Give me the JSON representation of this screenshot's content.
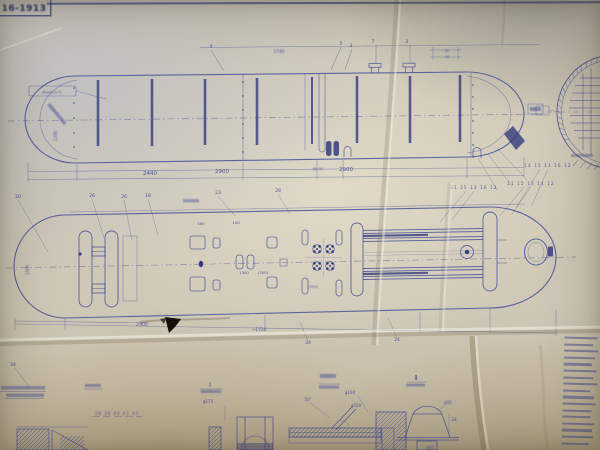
{
  "title_block": {
    "drawing_number": "16-1913"
  },
  "colors": {
    "ink": "#3f4896",
    "ink_dark": "#343b7e",
    "paper": "#cfc8b7",
    "tear": "#141008"
  },
  "notes_column": {
    "line_widths": [
      33,
      29,
      34,
      31,
      28,
      33,
      30,
      34,
      27,
      31,
      33,
      29,
      28,
      32,
      30,
      31,
      27
    ]
  },
  "annotations": [
    {
      "t": "2440",
      "x": 150,
      "y": 175,
      "s": 5.5,
      "n": "dim-2440"
    },
    {
      "t": "2900",
      "x": 222,
      "y": 173,
      "s": 5.5,
      "n": "dim-2900-a"
    },
    {
      "t": "80 40",
      "x": 318,
      "y": 170,
      "s": 3.6,
      "b": 0.4,
      "n": "dim-80-40"
    },
    {
      "t": "2900",
      "x": 346,
      "y": 171,
      "s": 5.5,
      "n": "dim-2900-b"
    },
    {
      "t": "5740",
      "x": 279,
      "y": 53,
      "s": 4.2,
      "b": 0.5,
      "n": "dim-5740"
    },
    {
      "t": "4",
      "x": 211,
      "y": 48,
      "s": 4.6,
      "n": "balloon-4"
    },
    {
      "t": "5",
      "x": 341,
      "y": 45,
      "s": 4.6,
      "n": "balloon-5"
    },
    {
      "t": "3",
      "x": 351,
      "y": 47,
      "s": 4.6,
      "n": "balloon-3"
    },
    {
      "t": "7",
      "x": 373,
      "y": 43,
      "s": 4.6,
      "n": "balloon-7"
    },
    {
      "t": "2",
      "x": 407,
      "y": 43,
      "s": 4.6,
      "n": "balloon-2"
    },
    {
      "t": "50",
      "x": 447,
      "y": 52,
      "s": 3.4,
      "b": 0.4,
      "n": "dim-50"
    },
    {
      "t": "40",
      "x": 447,
      "y": 58,
      "s": 3.4,
      "b": 0.4,
      "n": "dim-40"
    },
    {
      "t": "8mm≈175",
      "x": 52,
      "y": 93.5,
      "s": 3.6,
      "b": 0.5,
      "n": "note-8mm"
    },
    {
      "t": "1200",
      "x": 57,
      "y": 136,
      "s": 4,
      "r": -90,
      "b": 0.5,
      "n": "dim-1200"
    },
    {
      "t": "20",
      "x": 18,
      "y": 198,
      "s": 4.6,
      "n": "balloon-20"
    },
    {
      "t": "26",
      "x": 92,
      "y": 197,
      "s": 4.6,
      "n": "balloon-26-a"
    },
    {
      "t": "26",
      "x": 124,
      "y": 198,
      "s": 4.6,
      "n": "balloon-26-b"
    },
    {
      "t": "18",
      "x": 148,
      "y": 197,
      "s": 4.6,
      "n": "balloon-18"
    },
    {
      "t": "23",
      "x": 218,
      "y": 194,
      "s": 4.6,
      "n": "balloon-23"
    },
    {
      "t": "28",
      "x": 278,
      "y": 192,
      "s": 4.6,
      "n": "balloon-28"
    },
    {
      "t": "14 15 13 16 12",
      "x": 548,
      "y": 167,
      "s": 4,
      "ls": 1.2,
      "n": "balloon-row-a"
    },
    {
      "t": "11 15 13 14 12",
      "x": 531,
      "y": 185,
      "s": 4,
      "ls": 1.2,
      "n": "balloon-row-b"
    },
    {
      "t": "21 25 13 16 12",
      "x": 474,
      "y": 189,
      "s": 4,
      "ls": 1.2,
      "n": "balloon-row-c"
    },
    {
      "t": "580",
      "x": 201,
      "y": 225,
      "s": 3.8,
      "n": "dim-580"
    },
    {
      "t": "100",
      "x": 236,
      "y": 224,
      "s": 3.8,
      "n": "dim-100"
    },
    {
      "t": "1300",
      "x": 244,
      "y": 274,
      "s": 3.8,
      "n": "dim-1300"
    },
    {
      "t": "(300)",
      "x": 263,
      "y": 274,
      "s": 3.8,
      "n": "dim-300"
    },
    {
      "t": "(350)",
      "x": 313,
      "y": 288,
      "s": 3.8,
      "b": 0.4,
      "n": "dim-350"
    },
    {
      "t": "2905",
      "x": 142,
      "y": 326,
      "s": 4.6,
      "n": "dim-2905"
    },
    {
      "t": "~1724",
      "x": 259,
      "y": 331,
      "s": 4.2,
      "n": "dim-1724"
    },
    {
      "t": "34",
      "x": 308,
      "y": 344,
      "s": 4.6,
      "n": "balloon-34-a"
    },
    {
      "t": "24",
      "x": 397,
      "y": 341,
      "s": 4.6,
      "n": "balloon-24"
    },
    {
      "t": "1500",
      "x": 29,
      "y": 270,
      "s": 4,
      "r": -90,
      "b": 0.5,
      "n": "dim-1500"
    },
    {
      "t": "34",
      "x": 13,
      "y": 366,
      "s": 4.6,
      "n": "balloon-34-b"
    },
    {
      "t": "Ⅰ",
      "x": 210,
      "y": 387,
      "s": 7,
      "n": "detail-label-1"
    },
    {
      "t": "Ⅱ",
      "x": 416,
      "y": 380,
      "s": 7,
      "n": "detail-label-2"
    },
    {
      "t": "38 39 40 41 42",
      "x": 117,
      "y": 415,
      "s": 4,
      "ls": 1,
      "b": 0.4,
      "n": "part-number-row"
    },
    {
      "t": "φ175",
      "x": 208,
      "y": 403,
      "s": 4,
      "n": "dim-d175"
    },
    {
      "t": "50°",
      "x": 308,
      "y": 401,
      "s": 4,
      "n": "dim-50deg"
    },
    {
      "t": "φ190",
      "x": 350,
      "y": 394,
      "s": 4,
      "n": "dim-d190"
    },
    {
      "t": "φ550",
      "x": 356,
      "y": 407,
      "s": 4,
      "n": "dim-d550"
    },
    {
      "t": "φ95",
      "x": 448,
      "y": 404,
      "s": 4,
      "b": 0.4,
      "n": "dim-d95"
    },
    {
      "t": "28",
      "x": 454,
      "y": 421,
      "s": 4,
      "n": "dim-28"
    },
    {
      "t": "φ50",
      "x": 430,
      "y": 449,
      "s": 4,
      "b": 0.4,
      "n": "dim-d50"
    }
  ]
}
